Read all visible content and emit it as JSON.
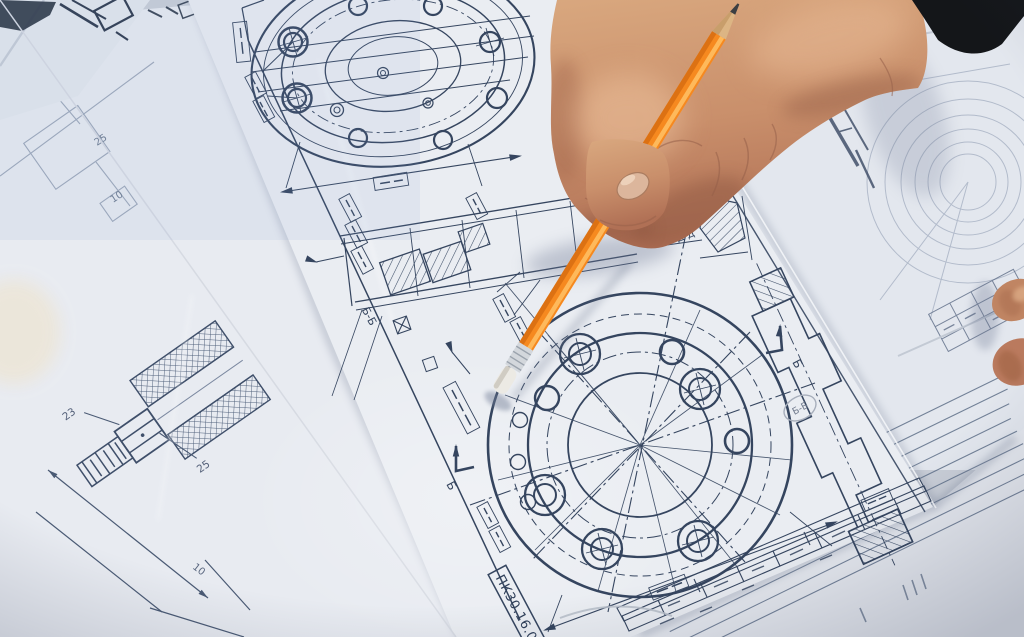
{
  "scene": {
    "alt": "Close-up photograph of a hand holding an orange pencil over mechanical engineering drawings of bolted flanges"
  },
  "drawing": {
    "number_stamp": "ПК30.16.0",
    "section_labels": {
      "bb": "Б-Б",
      "dd": "Д-Д",
      "cut_mark": "Б"
    },
    "dimensions": {
      "d23": "23",
      "d25": "25",
      "d10": "10"
    }
  },
  "colors": {
    "pencil_orange": "#f6891f",
    "pencil_wood": "#dcb584",
    "pencil_graphite": "#3b3e42",
    "eraser_white": "#eceae4",
    "ferrule_silver": "#d3d7dc",
    "paper": "#e9ecf1",
    "ink_blue": "#35455f",
    "skin": "#cf9a76",
    "sleeve_black": "#141619"
  }
}
